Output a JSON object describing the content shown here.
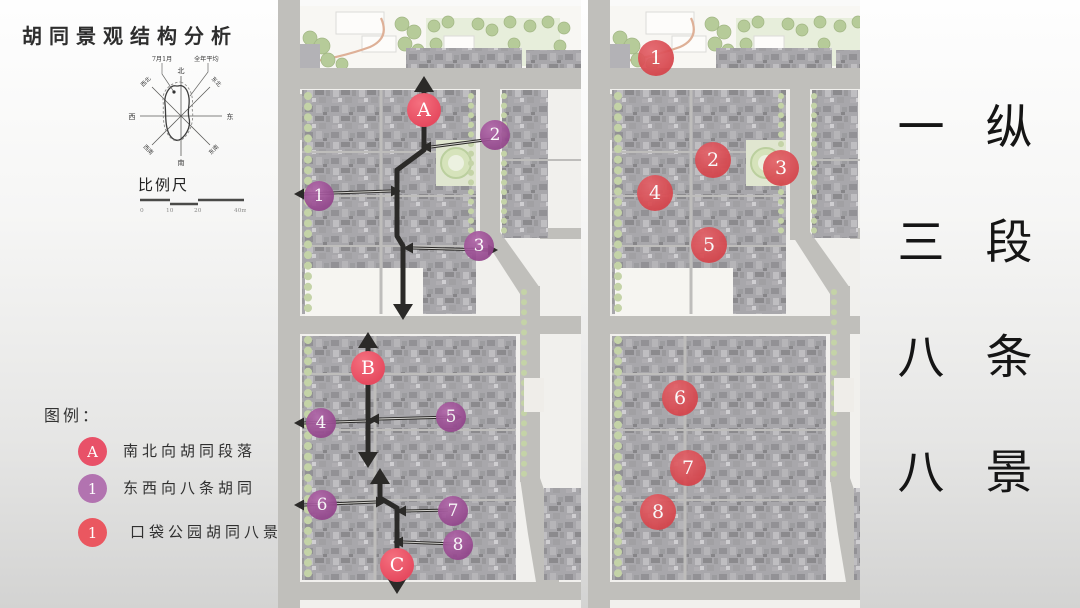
{
  "title": "胡同景观结构分析",
  "compass": {
    "annotation_july_jan": "7月1月",
    "annotation_annual": "全年平均",
    "north": "北",
    "south": "南",
    "east": "东",
    "west": "西",
    "northeast": "东北",
    "northwest": "西北",
    "southeast": "东南",
    "southwest": "西南"
  },
  "scalebar": {
    "label": "比例尺",
    "ticks": [
      "0",
      "10",
      "20",
      "40m"
    ]
  },
  "legend": {
    "title": "图例：",
    "items": [
      {
        "badge": "A",
        "color": "#e85168",
        "label": "南北向胡同段落"
      },
      {
        "badge": "1",
        "color": "#b273b0",
        "label": "东西向八条胡同"
      },
      {
        "badge": "1",
        "color": "#ea5760",
        "label": "口袋公园胡同八景"
      }
    ]
  },
  "marker_styles": {
    "segment": {
      "fill": "#e64a5f",
      "light": "#f4707f"
    },
    "hutong": {
      "fill": "#93458c",
      "light": "#b268aa"
    },
    "scene": {
      "fill": "#d6444b",
      "light": "#e4636a"
    }
  },
  "colors": {
    "arrow": "#2b2a28",
    "road": "#b4b3af",
    "tree": "#b9cb97"
  },
  "left_map": {
    "segment_markers": [
      {
        "label": "A",
        "x": 424,
        "y": 110
      },
      {
        "label": "B",
        "x": 368,
        "y": 368
      },
      {
        "label": "C",
        "x": 397,
        "y": 565
      }
    ],
    "hutong_markers": [
      {
        "label": "1",
        "x": 319,
        "y": 196
      },
      {
        "label": "2",
        "x": 495,
        "y": 135
      },
      {
        "label": "3",
        "x": 479,
        "y": 246
      },
      {
        "label": "4",
        "x": 321,
        "y": 423
      },
      {
        "label": "5",
        "x": 451,
        "y": 417
      },
      {
        "label": "6",
        "x": 322,
        "y": 505
      },
      {
        "label": "7",
        "x": 453,
        "y": 511
      },
      {
        "label": "8",
        "x": 458,
        "y": 545
      }
    ],
    "arrows": [
      {
        "kind": "axis",
        "pts": [
          [
            424,
            92
          ],
          [
            424,
            150
          ],
          [
            397,
            170
          ],
          [
            397,
            236
          ],
          [
            403,
            246
          ],
          [
            403,
            304
          ]
        ],
        "start": "up",
        "end": "down"
      },
      {
        "kind": "axis",
        "pts": [
          [
            368,
            348
          ],
          [
            368,
            452
          ]
        ],
        "start": "up",
        "end": "down"
      },
      {
        "kind": "axis",
        "pts": [
          [
            380,
            484
          ],
          [
            380,
            498
          ],
          [
            397,
            508
          ],
          [
            397,
            578
          ]
        ],
        "start": "up",
        "end": "down"
      },
      {
        "kind": "link",
        "pts": [
          [
            431,
            147
          ],
          [
            492,
            139
          ]
        ],
        "start": "left"
      },
      {
        "kind": "link",
        "pts": [
          [
            304,
            194
          ],
          [
            391,
            191
          ]
        ],
        "start": "left",
        "end": "right"
      },
      {
        "kind": "link",
        "pts": [
          [
            413,
            248
          ],
          [
            488,
            250
          ]
        ],
        "start": "left",
        "end": "right"
      },
      {
        "kind": "link",
        "pts": [
          [
            304,
            423
          ],
          [
            366,
            421
          ]
        ],
        "start": "left",
        "end": "right"
      },
      {
        "kind": "link",
        "pts": [
          [
            379,
            419
          ],
          [
            452,
            417
          ]
        ],
        "start": "left",
        "end": "right"
      },
      {
        "kind": "link",
        "pts": [
          [
            304,
            505
          ],
          [
            376,
            502
          ]
        ],
        "start": "left",
        "end": "right"
      },
      {
        "kind": "link",
        "pts": [
          [
            406,
            511
          ],
          [
            448,
            510
          ]
        ],
        "start": "left"
      },
      {
        "kind": "link",
        "pts": [
          [
            403,
            542
          ],
          [
            454,
            544
          ]
        ],
        "start": "left"
      }
    ]
  },
  "right_map": {
    "scene_markers": [
      {
        "label": "1",
        "x": 656,
        "y": 58
      },
      {
        "label": "2",
        "x": 713,
        "y": 160
      },
      {
        "label": "3",
        "x": 781,
        "y": 168
      },
      {
        "label": "4",
        "x": 655,
        "y": 193
      },
      {
        "label": "5",
        "x": 709,
        "y": 245
      },
      {
        "label": "6",
        "x": 680,
        "y": 398
      },
      {
        "label": "7",
        "x": 688,
        "y": 468
      },
      {
        "label": "8",
        "x": 658,
        "y": 512
      }
    ]
  },
  "summary": {
    "numbers": [
      "一",
      "三",
      "八",
      "八"
    ],
    "words": [
      "纵",
      "段",
      "条",
      "景"
    ]
  }
}
